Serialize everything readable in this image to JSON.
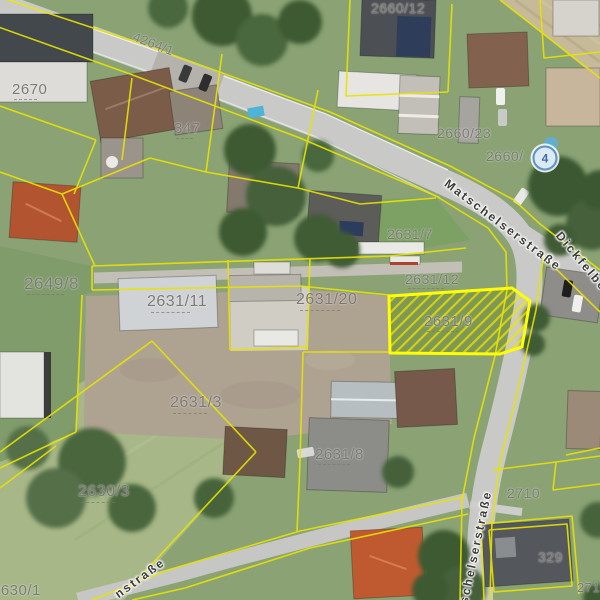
{
  "map": {
    "view": "aerial-cadastral",
    "highlighted_parcel": {
      "id": "2631/9"
    },
    "colors": {
      "parcel_line": "#e8e400",
      "highlight_outline": "#ffff00",
      "road": "#c9c9c7",
      "grass": "#8aa274",
      "parcel_label": "#7b7975",
      "street_label": "#3b3b39",
      "marker_ring": "#5b93c8"
    },
    "marker": {
      "label": "4",
      "x": 545,
      "y": 158
    },
    "parcel_labels": [
      {
        "text": "2670",
        "x": 12,
        "y": 82,
        "size": 15,
        "dash": true
      },
      {
        "text": "4264/1",
        "x": 136,
        "y": 30,
        "size": 13,
        "rot": 21
      },
      {
        "text": "347",
        "x": 174,
        "y": 121,
        "size": 15,
        "dash": true
      },
      {
        "text": "2660/12",
        "x": 371,
        "y": 1,
        "size": 14
      },
      {
        "text": "2660/23",
        "x": 437,
        "y": 126,
        "size": 14
      },
      {
        "text": "2660/",
        "x": 486,
        "y": 149,
        "size": 14
      },
      {
        "text": "2631/7",
        "x": 387,
        "y": 227,
        "size": 14
      },
      {
        "text": "2631/12",
        "x": 405,
        "y": 272,
        "size": 14,
        "dash": true
      },
      {
        "text": "2649/8",
        "x": 24,
        "y": 275,
        "size": 17,
        "dash": true
      },
      {
        "text": "2631/11",
        "x": 147,
        "y": 294,
        "size": 16,
        "dash": true
      },
      {
        "text": "2631/20",
        "x": 296,
        "y": 292,
        "size": 16,
        "dash": true
      },
      {
        "text": "2631/9",
        "x": 424,
        "y": 314,
        "size": 15,
        "dash": true
      },
      {
        "text": "2631/3",
        "x": 170,
        "y": 395,
        "size": 16,
        "dash": true
      },
      {
        "text": "2631/8",
        "x": 315,
        "y": 447,
        "size": 15,
        "dash": true
      },
      {
        "text": "2630/3",
        "x": 78,
        "y": 484,
        "size": 16,
        "dash": true
      },
      {
        "text": "2710",
        "x": 507,
        "y": 486,
        "size": 14
      },
      {
        "text": "329",
        "x": 538,
        "y": 550,
        "size": 14
      },
      {
        "text": "2710",
        "x": 577,
        "y": 581,
        "size": 13
      },
      {
        "text": "2630/1",
        "x": -8,
        "y": 583,
        "size": 15
      }
    ],
    "street_labels": [
      {
        "text": "Matschelserstraße",
        "x": 503,
        "y": 225,
        "rot": 37
      },
      {
        "text": "Dickfelber",
        "x": 584,
        "y": 264,
        "rot": 50
      },
      {
        "text": "tschelserstraße",
        "x": 475,
        "y": 550,
        "rot": -78
      },
      {
        "text": "nstraße",
        "x": 140,
        "y": 578,
        "rot": -36
      }
    ]
  }
}
